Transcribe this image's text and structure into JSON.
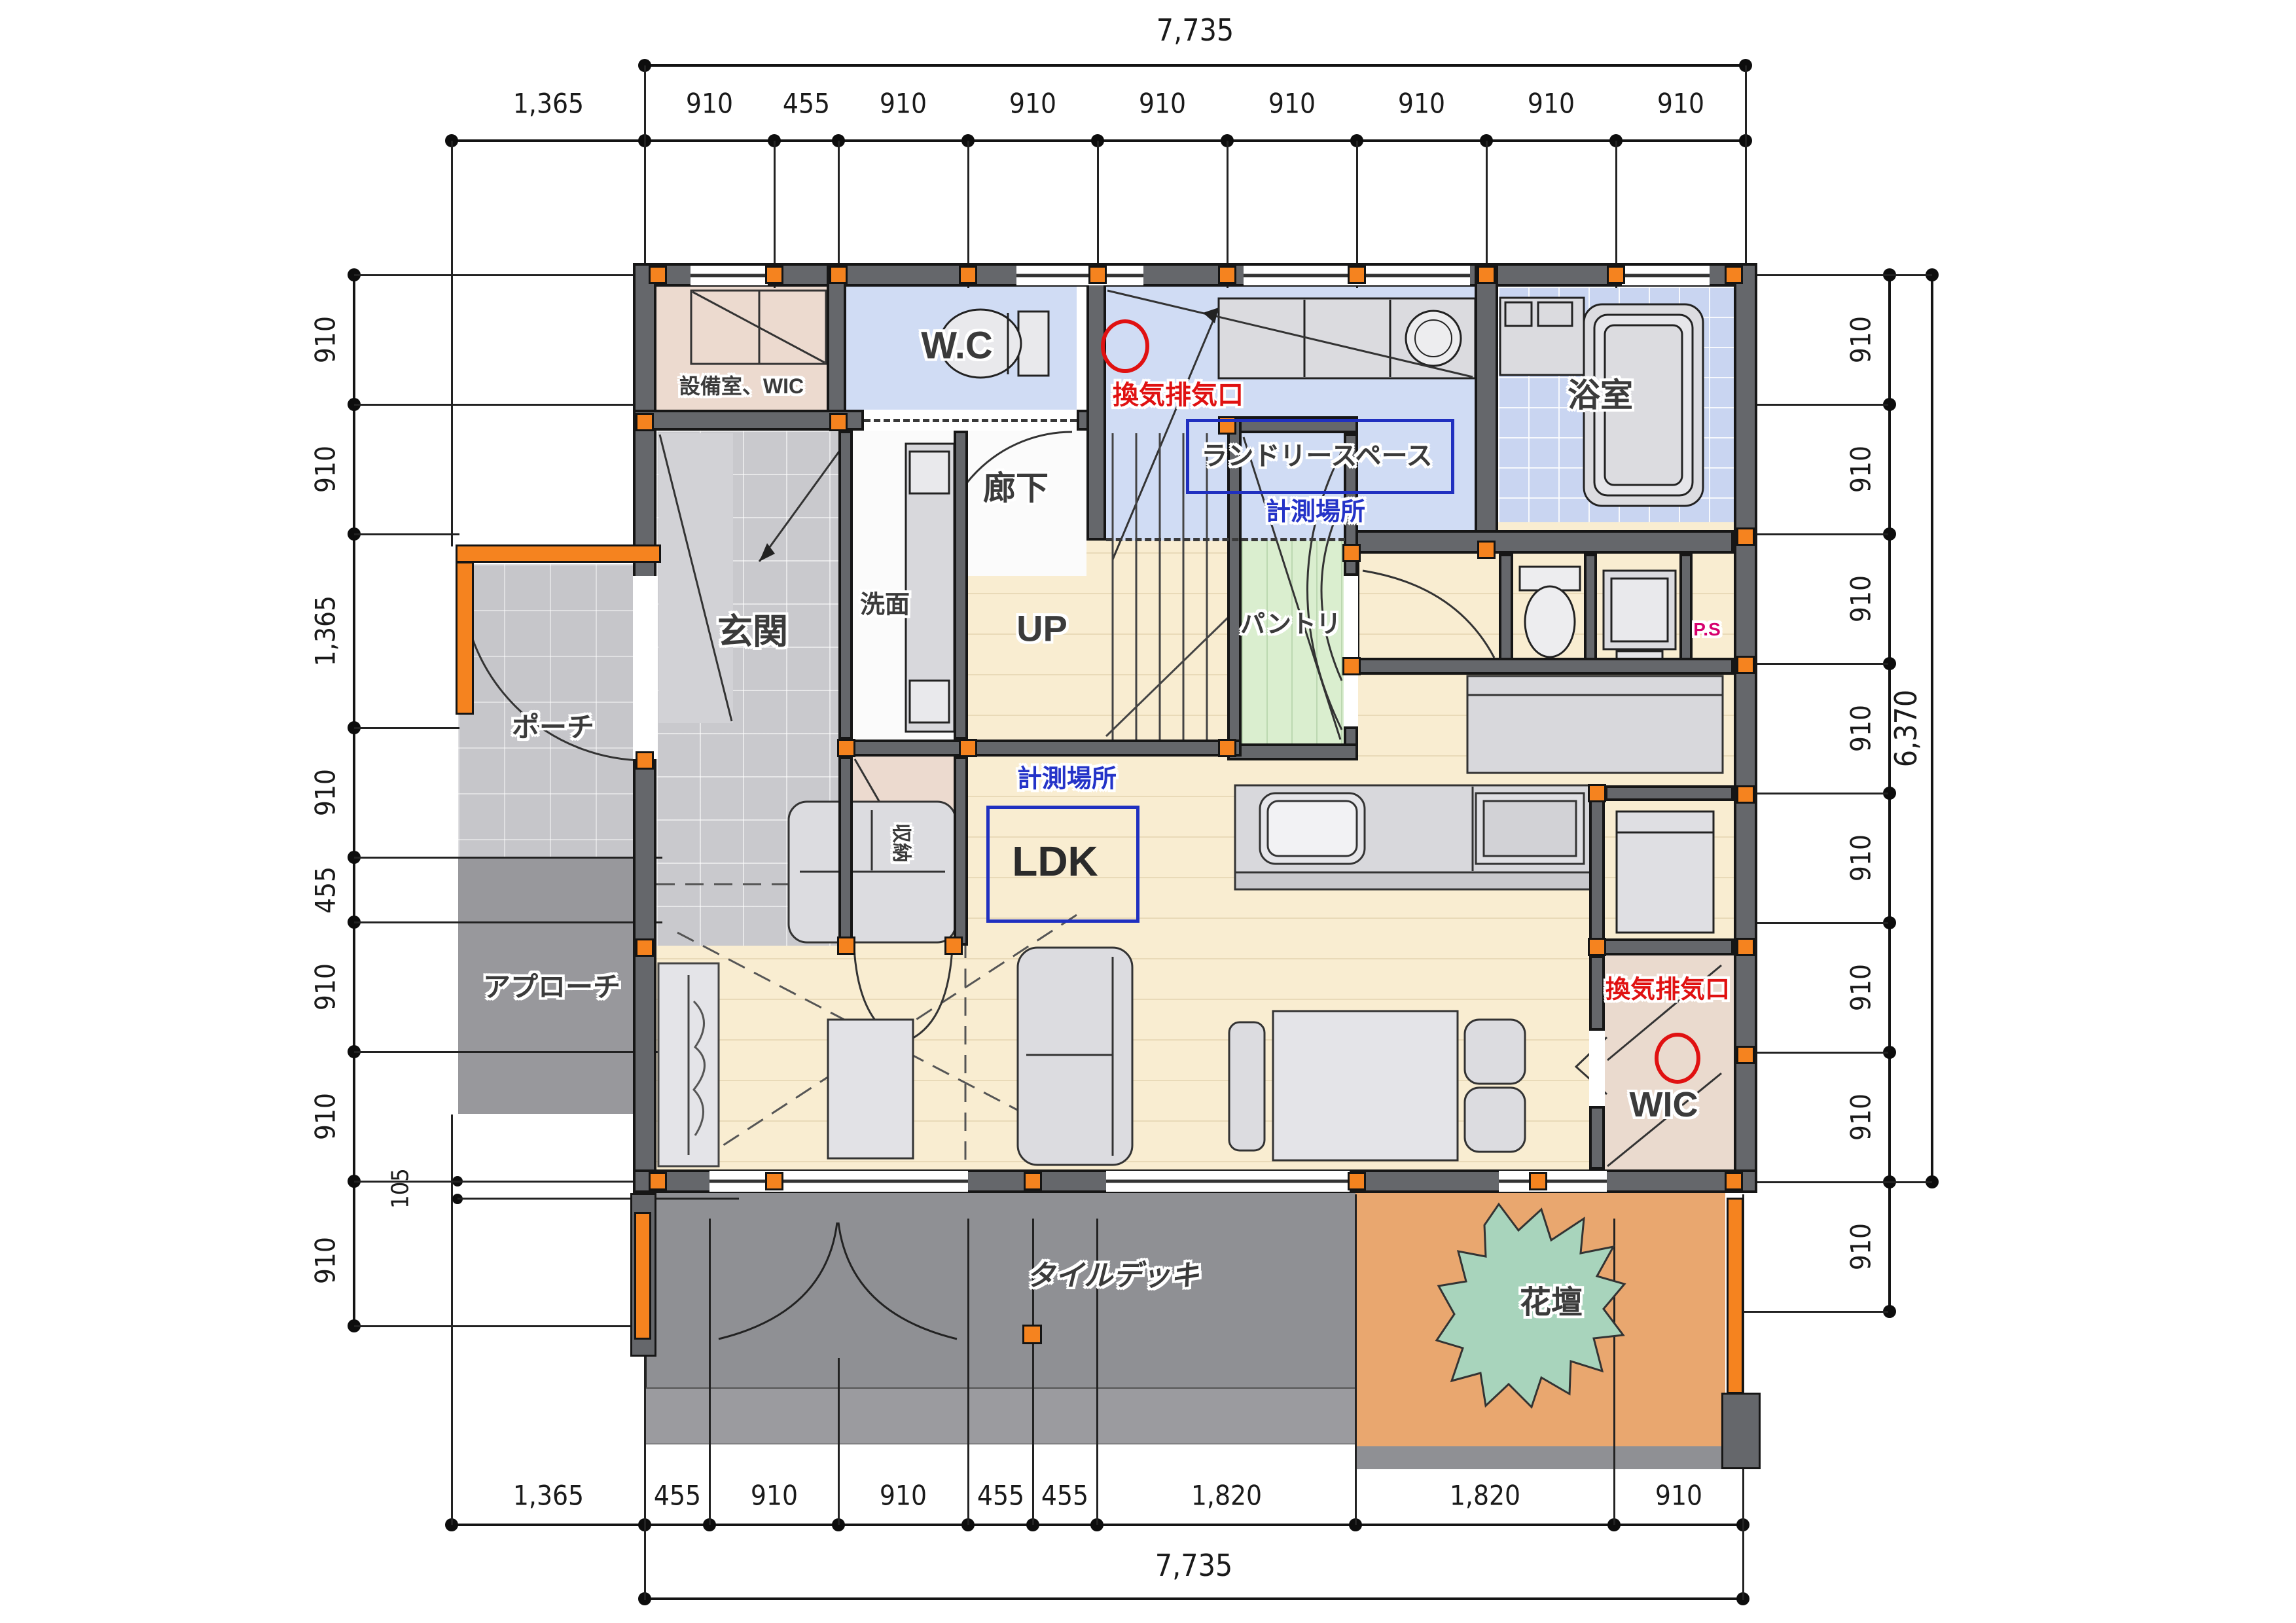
{
  "plan": {
    "rooms": {
      "equipment_wic": "設備室、WIC",
      "wc": "W.C",
      "corridor": "廊下",
      "laundry_space": "ランドリースペース",
      "bathroom": "浴室",
      "genkan": "玄関",
      "washroom": "洗面",
      "up": "UP",
      "pantry": "パントリ",
      "porch": "ポーチ",
      "storage": "収納",
      "ldk": "LDK",
      "approach": "アプローチ",
      "wic": "WIC",
      "flower_bed": "花壇",
      "tile_deck": "タイルデッキ",
      "ps": "P.S"
    },
    "annotations": {
      "vent_exhaust": "換気排気口",
      "measurement_point": "計測場所"
    },
    "dimensions": {
      "top": {
        "total": "7,735",
        "segments": [
          "1,365",
          "910",
          "455",
          "910",
          "910",
          "910",
          "910",
          "910",
          "910",
          "910"
        ]
      },
      "bottom": {
        "total": "7,735",
        "segments": [
          "1,365",
          "455",
          "910",
          "910",
          "455",
          "455",
          "1,820",
          "1,820",
          "910"
        ]
      },
      "left": {
        "segments": [
          "910",
          "910",
          "1,365",
          "910",
          "455",
          "910",
          "910",
          "910"
        ],
        "small": "105"
      },
      "right": {
        "total": "6,370",
        "segments": [
          "910",
          "910",
          "910",
          "910",
          "910",
          "910",
          "910",
          "910"
        ]
      }
    },
    "colors": {
      "wall": "#65676B",
      "pillar_orange": "#F5831F",
      "floor_wood": "#F9EDD1",
      "room_blue": "#D0DCF4",
      "room_pink": "#ECDACF",
      "pantry_green": "#DAEECF",
      "deck_gray": "#8F9094",
      "flower_bed_orange": "#E9A76F",
      "plant_green": "#A8D4BC",
      "annotation_blue": "#2433C8",
      "annotation_red": "#E01111",
      "ps_magenta": "#D6006E"
    }
  }
}
